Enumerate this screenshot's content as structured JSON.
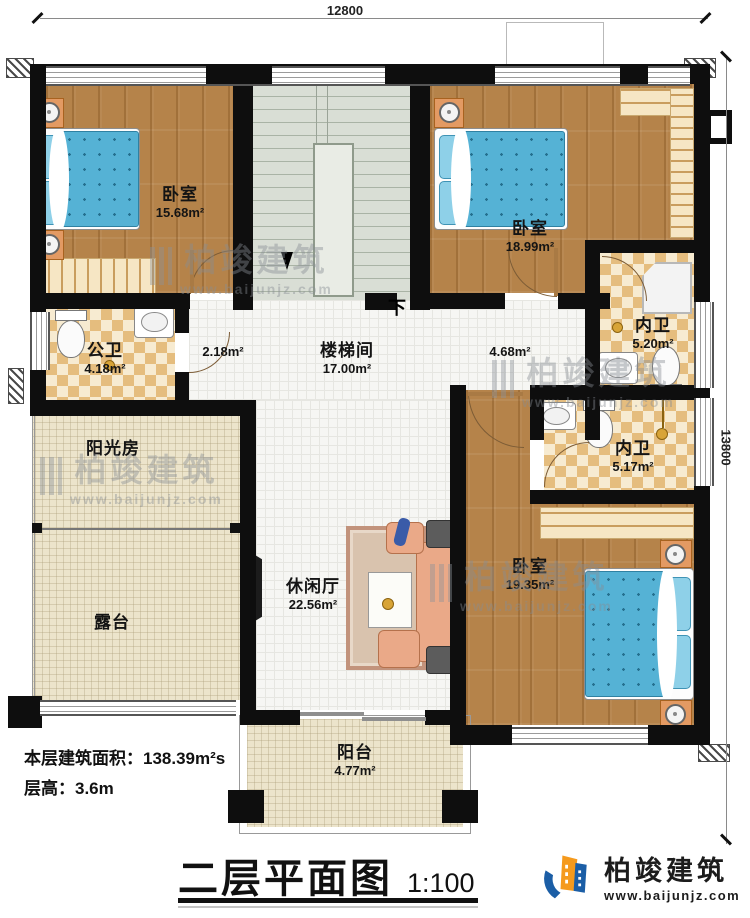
{
  "dimensions": {
    "top": "12800",
    "right": "13800"
  },
  "rooms": [
    {
      "name": "卧室",
      "area": "15.68m²"
    },
    {
      "name": "楼梯间",
      "area": "17.00m²"
    },
    {
      "name": "卧室",
      "area": "18.99m²"
    },
    {
      "name": "内卫",
      "area": "5.20m²"
    },
    {
      "name": "公卫",
      "area": "4.18m²"
    },
    {
      "area": "2.18m²"
    },
    {
      "area": "4.68m²"
    },
    {
      "name": "阳光房"
    },
    {
      "name": "露台"
    },
    {
      "name": "休闲厅",
      "area": "22.56m²"
    },
    {
      "name": "内卫",
      "area": "5.17m²"
    },
    {
      "name": "卧室",
      "area": "19.35m²"
    },
    {
      "name": "阳台",
      "area": "4.77m²"
    }
  ],
  "stairs": {
    "down_label": "下"
  },
  "footer": {
    "floor_area_line": "本层建筑面积：138.39m²s",
    "floor_height_line": "层高：3.6m"
  },
  "title": {
    "text": "二层平面图",
    "scale": "1:100"
  },
  "brand": {
    "name": "柏竣建筑",
    "url": "www.baijunjz.com"
  },
  "colors": {
    "wall": "#0e0e0e",
    "wood_floor": "#b5834a",
    "bath_tile": "#e5bd7e",
    "bed_blue": "#55b2d5",
    "logo_blue": "#1b5ea6",
    "logo_orange": "#f59a1d"
  }
}
